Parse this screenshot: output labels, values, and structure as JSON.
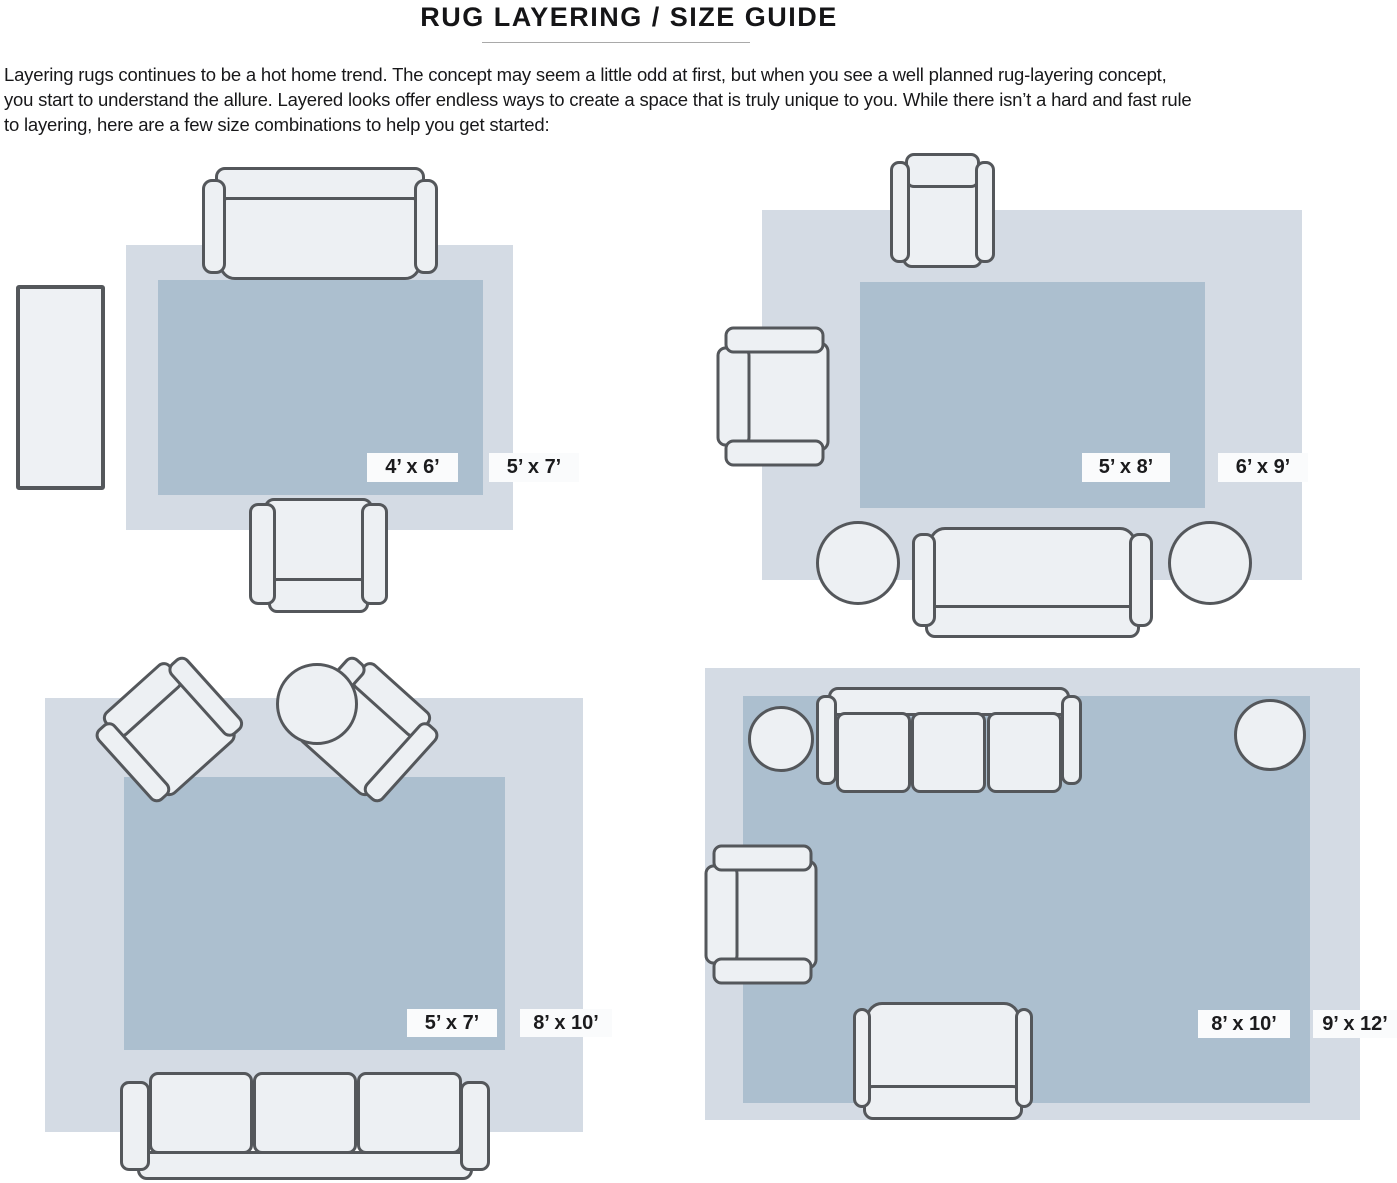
{
  "title": "RUG LAYERING / SIZE GUIDE",
  "intro": {
    "lines": [
      "Layering rugs continues to be a hot home trend. The concept may seem a little odd at first, but when you see a well planned rug-layering concept,",
      "you start to understand the allure. Layered looks offer endless ways to create a space that is truly unique to you. While there isn’t a hard and fast rule",
      "to layering, here are a few size combinations to help you get started:"
    ]
  },
  "colors": {
    "outer_rug": "#d4dbe4",
    "inner_rug": "#acbfcf",
    "furniture_fill": "#edf0f3",
    "furniture_outline": "#54575b",
    "label_bg": "#fafbfc",
    "text": "#1b1b1d"
  },
  "panels": [
    {
      "inner_size": "4’ x 6’",
      "outer_size": "5’ x 7’"
    },
    {
      "inner_size": "5’ x 8’",
      "outer_size": "6’ x 9’"
    },
    {
      "inner_size": "5’ x 7’",
      "outer_size": "8’ x 10’"
    },
    {
      "inner_size": "8’ x 10’",
      "outer_size": "9’ x 12’"
    }
  ]
}
